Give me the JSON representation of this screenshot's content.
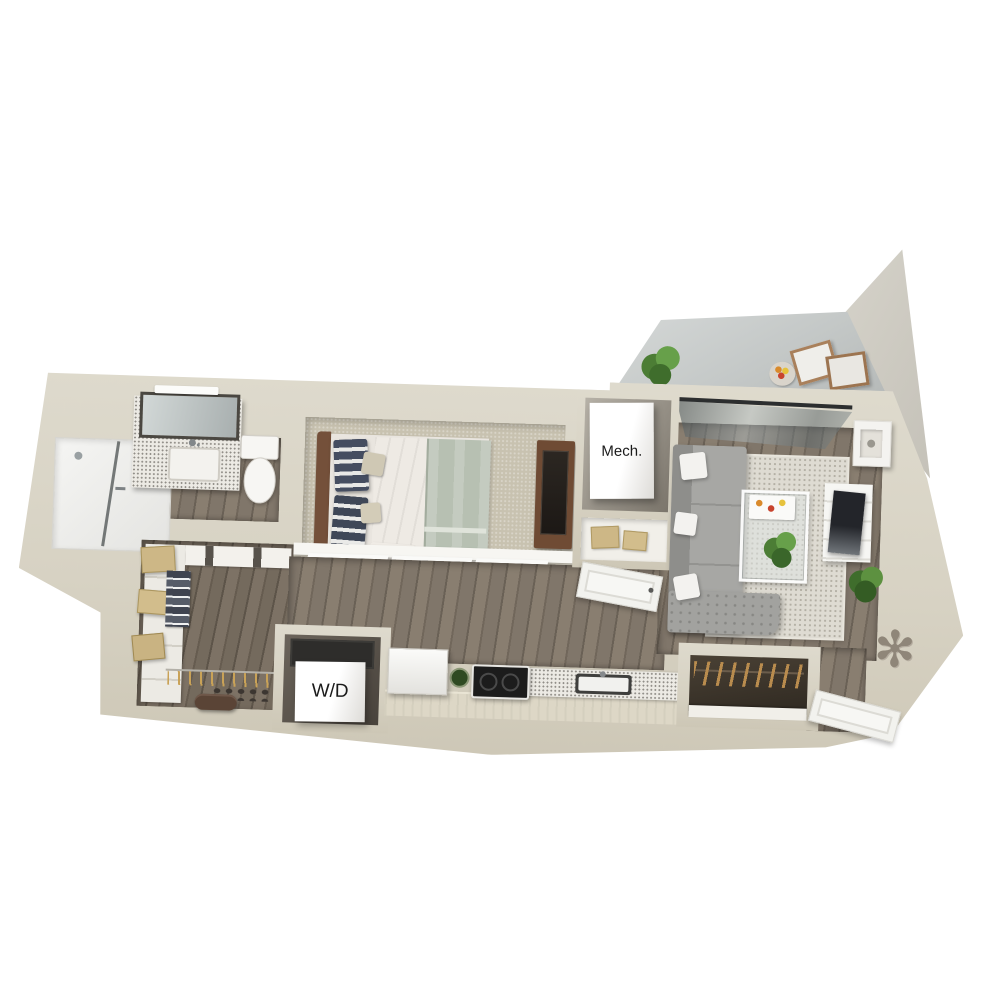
{
  "plan": {
    "type": "3d-isometric-floorplan",
    "labels": {
      "mech_room": "Mech.",
      "laundry": "W/D"
    },
    "colors": {
      "background": "#ffffff",
      "wall": "#d7d2c3",
      "wall_shadow": "#c9c3b2",
      "tall_wall": "#cfccc3",
      "wood_floor": "#786d60",
      "carpet": "#c8c2b0",
      "balcony_concrete": "#c4c8c7",
      "area_rug": "#dedbd2",
      "sofa_gray": "#a5a5a2",
      "navy_pillow": "#454d60",
      "blanket_sage": "#b7c0b2",
      "wood_furniture": "#6f4b34",
      "appliance_black": "#1e1e1e",
      "fixture_white": "#f6f5f2",
      "counter_speckle": "#eceae4",
      "plant_green": "#527f38",
      "hanger_tan": "#c9a257"
    },
    "rooms": [
      {
        "name": "bathroom",
        "items": [
          "walk-in-shower",
          "glass-shower-door",
          "vanity-terrazzo-counter",
          "sink",
          "leaning-mirror",
          "vanity-light-bar",
          "toilet"
        ]
      },
      {
        "name": "bedroom",
        "items": [
          "bed",
          "wood-headboard",
          "navy-striped-pillows",
          "tan-accent-pillows",
          "sage-blanket",
          "media-dresser",
          "tv",
          "frosted-sliding-doors"
        ]
      },
      {
        "name": "walk-in-closet",
        "items": [
          "shelving-unit",
          "tan-storage-boxes",
          "folded-clothes",
          "hanging-rod",
          "wood-hangers",
          "shoes",
          "duffel-bag"
        ]
      },
      {
        "name": "laundry-closet",
        "items": [
          "stacked-washer-dryer"
        ],
        "label_key": "laundry"
      },
      {
        "name": "mechanical-closet",
        "items": [
          "hvac-unit",
          "storage-nook",
          "tan-boxes",
          "white-panel-door"
        ],
        "label_key": "mech_room"
      },
      {
        "name": "kitchen",
        "items": [
          "refrigerator",
          "herb-plant",
          "black-cooktop-stove",
          "speckled-counter",
          "sink"
        ]
      },
      {
        "name": "living-room",
        "items": [
          "gray-tufted-sectional",
          "white-throw-pillows",
          "speckled-area-rug",
          "glass-coffee-table",
          "food-tray",
          "table-plant",
          "white-media-console",
          "tv",
          "wall-cube-shelf",
          "potted-plant",
          "sliding-glass-door"
        ]
      },
      {
        "name": "entry",
        "items": [
          "coat-closet",
          "wood-hangers",
          "open-entry-door",
          "sunburst-wall-art"
        ]
      },
      {
        "name": "balcony",
        "items": [
          "concrete-floor",
          "potted-palm",
          "fruit-tray-table",
          "folding-lounge-chairs",
          "tall-privacy-wall"
        ]
      }
    ]
  }
}
